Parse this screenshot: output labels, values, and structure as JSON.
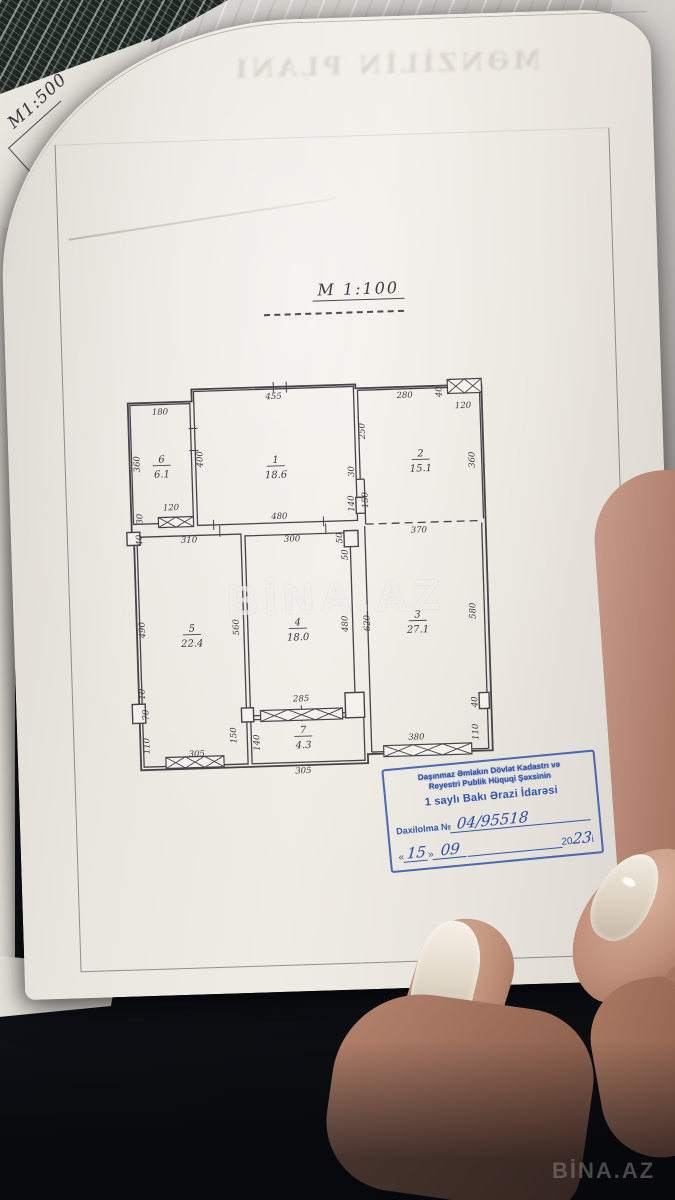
{
  "scene": {
    "underlay_scale_label": "М1:500",
    "bleed_header": "MƏNZİLİN PLANI",
    "watermark_center": "BİNA.AZ",
    "watermark_corner": "BİNA.AZ"
  },
  "heading": {
    "scale": "M 1:100"
  },
  "stamp": {
    "org_line1": "Daşınmaz Əmlakın Dövlət Kadastrı və",
    "org_line2": "Reyestri Publik Hüquqi Şəxsinin",
    "office": "1 saylı Bakı Ərazi İdarəsi",
    "entry_label": "Daxilolma №",
    "entry_number": "04/95518",
    "open_quote": "«",
    "day": "15",
    "close_quote": "»",
    "month": "09",
    "year_prefix": "20",
    "year": "23",
    "year_suffix": "i"
  },
  "floor_plan": {
    "outline": [
      [
        17,
        29
      ],
      [
        81,
        29
      ],
      [
        81,
        17
      ],
      [
        245,
        17
      ],
      [
        245,
        21
      ],
      [
        371,
        21
      ],
      [
        371,
        387
      ],
      [
        246,
        387
      ],
      [
        246,
        396
      ],
      [
        19,
        396
      ],
      [
        19,
        161
      ],
      [
        17,
        161
      ]
    ],
    "rooms": [
      {
        "number": "6",
        "area": "6.1",
        "label_x": 49,
        "label_y": 89,
        "rect": [
          19,
          31,
          60,
          119
        ]
      },
      {
        "number": "1",
        "area": "18.6",
        "label_x": 163,
        "label_y": 93,
        "rect": [
          83,
          19,
          160,
          134
        ]
      },
      {
        "number": "2",
        "area": "15.1",
        "label_x": 308,
        "label_y": 91,
        "sides": [
          [
            247,
            23,
            247,
            112
          ],
          [
            247,
            23,
            369,
            23
          ],
          [
            369,
            23,
            369,
            155
          ]
        ]
      },
      {
        "number": "5",
        "area": "22.4",
        "label_x": 74,
        "label_y": 259,
        "rect": [
          22,
          163,
          104,
          230
        ]
      },
      {
        "number": "4",
        "area": "18.0",
        "label_x": 180,
        "label_y": 256,
        "rect": [
          130,
          165,
          105,
          180
        ]
      },
      {
        "number": "3",
        "area": "27.1",
        "label_x": 300,
        "label_y": 252,
        "sides": [
          [
            250,
            159,
            250,
            385
          ],
          [
            250,
            385,
            367,
            385
          ],
          [
            367,
            159,
            367,
            385
          ]
        ]
      },
      {
        "number": "7",
        "area": "4.3",
        "label_x": 182,
        "label_y": 364,
        "rect": [
          130,
          349,
          113,
          44
        ]
      }
    ],
    "extra_walls": [
      [
        243,
        112,
        251,
        112
      ],
      [
        251,
        112,
        251,
        157
      ]
    ],
    "dashed_walls": [
      [
        251,
        157,
        367,
        157
      ]
    ],
    "windows": [
      [
        337,
        15,
        34,
        14,
        2
      ],
      [
        44,
        144,
        35,
        10,
        2
      ],
      [
        44,
        384,
        58,
        11,
        3
      ],
      [
        140,
        340,
        82,
        11,
        3
      ],
      [
        262,
        379,
        88,
        11,
        3
      ]
    ],
    "piers": [
      [
        12,
        158,
        13,
        13
      ],
      [
        12,
        330,
        13,
        19
      ],
      [
        121,
        337,
        12,
        14
      ],
      [
        225,
        325,
        19,
        25
      ],
      [
        229,
        163,
        14,
        16
      ],
      [
        359,
        329,
        10,
        16
      ],
      [
        242,
        130,
        9,
        16
      ]
    ],
    "ticks": [
      [
        163,
        12,
        163,
        23
      ],
      [
        176,
        12,
        176,
        23
      ],
      [
        99,
        148,
        99,
        158
      ],
      [
        209,
        148,
        209,
        158
      ],
      [
        77,
        56,
        86,
        56
      ],
      [
        77,
        78,
        86,
        78
      ],
      [
        211,
        155,
        211,
        166
      ],
      [
        105,
        154,
        105,
        165
      ],
      [
        181,
        336,
        181,
        352
      ]
    ],
    "dims": [
      {
        "t": "180",
        "x": 49,
        "y": 41
      },
      {
        "t": "455",
        "x": 163,
        "y": 29
      },
      {
        "t": "280",
        "x": 294,
        "y": 32
      },
      {
        "t": "40",
        "x": 331,
        "y": 27,
        "r": 1
      },
      {
        "t": "120",
        "x": 352,
        "y": 44
      },
      {
        "t": "360",
        "x": 27,
        "y": 90,
        "r": 1
      },
      {
        "t": "400",
        "x": 90,
        "y": 87,
        "r": 1
      },
      {
        "t": "250",
        "x": 253,
        "y": 64,
        "r": 1
      },
      {
        "t": "30",
        "x": 241,
        "y": 104,
        "r": 1
      },
      {
        "t": "140",
        "x": 240,
        "y": 136,
        "r": 1
      },
      {
        "t": "150",
        "x": 254,
        "y": 133,
        "r": 1
      },
      {
        "t": "360",
        "x": 362,
        "y": 96,
        "r": 1
      },
      {
        "t": "120",
        "x": 57,
        "y": 137
      },
      {
        "t": "30",
        "x": 28,
        "y": 145,
        "r": 1
      },
      {
        "t": "480",
        "x": 165,
        "y": 149
      },
      {
        "t": "40",
        "x": 27,
        "y": 166,
        "r": 1
      },
      {
        "t": "310",
        "x": 74,
        "y": 170
      },
      {
        "t": "300",
        "x": 177,
        "y": 172
      },
      {
        "t": "50",
        "x": 227,
        "y": 170,
        "r": 1
      },
      {
        "t": "50",
        "x": 232,
        "y": 187,
        "r": 1
      },
      {
        "t": "370",
        "x": 304,
        "y": 167
      },
      {
        "t": "490",
        "x": 27,
        "y": 256,
        "r": 1
      },
      {
        "t": "560",
        "x": 121,
        "y": 256,
        "r": 1
      },
      {
        "t": "480",
        "x": 230,
        "y": 256,
        "r": 1
      },
      {
        "t": "620",
        "x": 252,
        "y": 256,
        "r": 1
      },
      {
        "t": "580",
        "x": 358,
        "y": 247,
        "r": 1
      },
      {
        "t": "10",
        "x": 25,
        "y": 320,
        "r": 1
      },
      {
        "t": "70",
        "x": 28,
        "y": 341,
        "r": 1
      },
      {
        "t": "110",
        "x": 28,
        "y": 372,
        "r": 1
      },
      {
        "t": "305",
        "x": 75,
        "y": 384
      },
      {
        "t": "150",
        "x": 115,
        "y": 364,
        "r": 1
      },
      {
        "t": "140",
        "x": 138,
        "y": 372,
        "r": 1
      },
      {
        "t": "285",
        "x": 181,
        "y": 332
      },
      {
        "t": "40",
        "x": 357,
        "y": 338,
        "r": 1
      },
      {
        "t": "110",
        "x": 357,
        "y": 368,
        "r": 1
      },
      {
        "t": "380",
        "x": 295,
        "y": 374
      },
      {
        "t": "305",
        "x": 181,
        "y": 404
      }
    ]
  }
}
